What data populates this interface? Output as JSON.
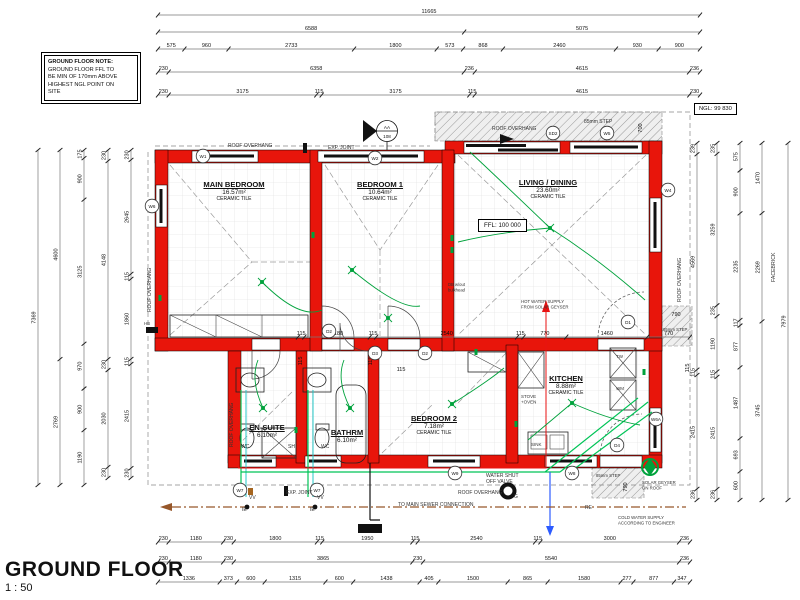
{
  "sheet": {
    "title": "GROUND FLOOR",
    "scale": "1 : 50",
    "note_lines": [
      "GROUND FLOOR NOTE:",
      "GROUND FLOOR FFL TO",
      "BE MIN OF 170mm ABOVE",
      "HIGHEST NGL POINT ON",
      "SITE"
    ],
    "ngl": "NGL: 99 830",
    "ffl": "FFL: 100 000",
    "facebrick": "FACEBRICK",
    "section": {
      "top": "AA",
      "bottom": "108"
    }
  },
  "rooms": [
    {
      "name": "MAIN BEDROOM",
      "area": "16.57m²",
      "finish": "CERAMIC TILE",
      "x": 234,
      "y": 180
    },
    {
      "name": "BEDROOM 1",
      "area": "10.64m²",
      "finish": "CERAMIC TILE",
      "x": 380,
      "y": 180
    },
    {
      "name": "LIVING / DINING",
      "area": "23.60m²",
      "finish": "CERAMIC TILE",
      "x": 548,
      "y": 178
    },
    {
      "name": "EN-SUITE",
      "area": "6.10m²",
      "finish": "",
      "x": 267,
      "y": 423
    },
    {
      "name": "BATHRM",
      "area": "6.10m²",
      "finish": "",
      "x": 347,
      "y": 428
    },
    {
      "name": "BEDROOM 2",
      "area": "7.18m²",
      "finish": "CERAMIC TILE",
      "x": 434,
      "y": 414
    },
    {
      "name": "KITCHEN",
      "area": "8.88m²",
      "finish": "CERAMIC TILE",
      "x": 566,
      "y": 374
    }
  ],
  "markers": [
    {
      "label": "W6",
      "x": 152,
      "y": 206
    },
    {
      "label": "W1",
      "x": 203,
      "y": 156
    },
    {
      "label": "W2",
      "x": 375,
      "y": 158
    },
    {
      "label": "SD2",
      "x": 553,
      "y": 133
    },
    {
      "label": "W5",
      "x": 607,
      "y": 133
    },
    {
      "label": "W4",
      "x": 668,
      "y": 190
    },
    {
      "label": "D1",
      "x": 628,
      "y": 322
    },
    {
      "label": "D2",
      "x": 329,
      "y": 331
    },
    {
      "label": "D3",
      "x": 375,
      "y": 353
    },
    {
      "label": "D2",
      "x": 425,
      "y": 353
    },
    {
      "label": "D4",
      "x": 617,
      "y": 445
    },
    {
      "label": "W7",
      "x": 240,
      "y": 490
    },
    {
      "label": "W7",
      "x": 317,
      "y": 490
    },
    {
      "label": "W9",
      "x": 455,
      "y": 473
    },
    {
      "label": "W8",
      "x": 572,
      "y": 473
    },
    {
      "label": "W6A",
      "x": 656,
      "y": 419
    }
  ],
  "annotations": [
    {
      "t": [
        "ROOF OVERHANG"
      ],
      "x": 228,
      "y": 147
    },
    {
      "t": [
        "EXP. JOINT"
      ],
      "x": 328,
      "y": 149
    },
    {
      "t": [
        "ROOF OVERHANG"
      ],
      "x": 492,
      "y": 130
    },
    {
      "t": [
        "85mm STEP"
      ],
      "x": 584,
      "y": 123
    },
    {
      "t": [
        "ROOF OVERHANG"
      ],
      "x": 151,
      "y": 312,
      "r": -90
    },
    {
      "t": [
        "ROOF OVERHANG"
      ],
      "x": 681,
      "y": 302,
      "r": -90
    },
    {
      "t": [
        "ROOF OVERHANG"
      ],
      "x": 233,
      "y": 447,
      "r": -90
    },
    {
      "t": [
        "ROOF OVERHANG"
      ],
      "x": 458,
      "y": 494
    },
    {
      "t": [
        "EXP. JOINT"
      ],
      "x": 286,
      "y": 494
    },
    {
      "t": [
        "TO MAIN SEWER CONNECTION"
      ],
      "x": 398,
      "y": 506
    },
    {
      "t": [
        "COLD WATER SUPPLY",
        "ACCORDING TO ENGINEER"
      ],
      "x": 618,
      "y": 519,
      "fs": 4.3
    },
    {
      "t": [
        "WATER SHUT",
        "OFF VALVE"
      ],
      "x": 486,
      "y": 477
    },
    {
      "t": [
        "HOT WATER SUPPLY",
        "FROM SOLAR GEYSER"
      ],
      "x": 521,
      "y": 303,
      "c": "#0a7a30",
      "fs": 4.3
    },
    {
      "t": [
        "SOLAR GEYSER",
        "ON ROOF"
      ],
      "x": 642,
      "y": 484,
      "c": "#0a7a30",
      "fs": 4.3
    },
    {
      "t": [
        "85mm STEP"
      ],
      "x": 663,
      "y": 331,
      "fs": 4.3
    },
    {
      "t": [
        "85mm STEP"
      ],
      "x": 596,
      "y": 477,
      "fs": 4.3
    },
    {
      "t": [
        "DB w/out",
        "bulkhead"
      ],
      "x": 448,
      "y": 286,
      "fs": 4.2
    },
    {
      "t": [
        "WC"
      ],
      "x": 241,
      "y": 448
    },
    {
      "t": [
        "SH"
      ],
      "x": 288,
      "y": 448
    },
    {
      "t": [
        "WC"
      ],
      "x": 321,
      "y": 448
    },
    {
      "t": [
        "STOVE",
        "+OVEN"
      ],
      "x": 521,
      "y": 398,
      "fs": 4.5
    },
    {
      "t": [
        "SINK"
      ],
      "x": 531,
      "y": 446,
      "fs": 4.5
    },
    {
      "t": [
        "TW"
      ],
      "x": 616,
      "y": 358,
      "fs": 4.5
    },
    {
      "t": [
        "WM"
      ],
      "x": 616,
      "y": 390,
      "fs": 4.5
    },
    {
      "t": [
        "HB"
      ],
      "x": 144,
      "y": 325,
      "fs": 4.3
    },
    {
      "t": [
        "VV"
      ],
      "x": 249,
      "y": 499
    },
    {
      "t": [
        "VV"
      ],
      "x": 317,
      "y": 499
    },
    {
      "t": [
        "IE"
      ],
      "x": 242,
      "y": 511
    },
    {
      "t": [
        "IE"
      ],
      "x": 310,
      "y": 511
    },
    {
      "t": [
        "G"
      ],
      "x": 514,
      "y": 498
    },
    {
      "t": [
        "RE"
      ],
      "x": 585,
      "y": 509
    },
    {
      "t": [
        "FACEBRICK"
      ],
      "x": 775,
      "y": 282,
      "r": -90,
      "fs": 5.2
    }
  ],
  "solo_dims": [
    {
      "t": "700",
      "x": 642,
      "y": 128,
      "r": -90
    },
    {
      "t": "790",
      "x": 676,
      "y": 316
    },
    {
      "t": "115",
      "x": 689,
      "y": 368,
      "r": -90
    },
    {
      "t": "790",
      "x": 627,
      "y": 487,
      "r": -90
    },
    {
      "t": "115",
      "x": 302,
      "y": 361,
      "r": -90
    },
    {
      "t": "115",
      "x": 372,
      "y": 361,
      "r": -90
    },
    {
      "t": "115",
      "x": 401,
      "y": 371
    }
  ],
  "dims": {
    "chains": [
      {
        "dir": "h",
        "y": 15,
        "x1": 158,
        "x2": 700,
        "v": [
          11665
        ]
      },
      {
        "dir": "h",
        "y": 32,
        "x1": 158,
        "x2": 700,
        "v": [
          6588,
          5075
        ]
      },
      {
        "dir": "h",
        "y": 49,
        "x1": 158,
        "x2": 700,
        "v": [
          575,
          960,
          2733,
          1800,
          573,
          868,
          2460,
          930,
          900
        ]
      },
      {
        "dir": "h",
        "y": 72,
        "x1": 158,
        "x2": 700,
        "v": [
          230,
          6358,
          236,
          4615,
          236
        ]
      },
      {
        "dir": "h",
        "y": 95,
        "x1": 158,
        "x2": 700,
        "v": [
          230,
          3175,
          115,
          3175,
          115,
          4615,
          230
        ]
      },
      {
        "dir": "h",
        "y": 337,
        "x1": 298,
        "x2": 690,
        "v": [
          115,
          1180,
          115,
          2540,
          115,
          770,
          1460,
          770
        ]
      },
      {
        "dir": "h",
        "y": 542,
        "x1": 158,
        "x2": 690,
        "v": [
          230,
          1180,
          230,
          1800,
          115,
          1950,
          115,
          2540,
          115,
          3000,
          236
        ]
      },
      {
        "dir": "h",
        "y": 562,
        "x1": 158,
        "x2": 690,
        "v": [
          230,
          1180,
          230,
          3865,
          230,
          5540,
          236
        ]
      },
      {
        "dir": "h",
        "y": 582,
        "x1": 158,
        "x2": 690,
        "v": [
          1336,
          373,
          600,
          1315,
          600,
          1438,
          405,
          1500,
          865,
          1580,
          277,
          877,
          347
        ]
      },
      {
        "dir": "v",
        "x": 38,
        "y1": 150,
        "y2": 485,
        "v": [
          7369
        ]
      },
      {
        "dir": "v",
        "x": 60,
        "y1": 150,
        "y2": 485,
        "v": [
          4600,
          2769
        ]
      },
      {
        "dir": "v",
        "x": 84,
        "y1": 150,
        "y2": 485,
        "v": [
          175,
          900,
          3125,
          970,
          900,
          1190
        ]
      },
      {
        "dir": "v",
        "x": 108,
        "y1": 150,
        "y2": 478,
        "v": [
          230,
          4148,
          230,
          2030,
          230
        ]
      },
      {
        "dir": "v",
        "x": 131,
        "y1": 150,
        "y2": 478,
        "v": [
          230,
          2645,
          115,
          1860,
          115,
          2415,
          230
        ]
      },
      {
        "dir": "v",
        "x": 697,
        "y1": 143,
        "y2": 500,
        "v": [
          239,
          4569,
          115,
          2415,
          236
        ]
      },
      {
        "dir": "v",
        "x": 717,
        "y1": 143,
        "y2": 500,
        "v": [
          235,
          3259,
          235,
          1190,
          115,
          2415,
          236
        ]
      },
      {
        "dir": "v",
        "x": 740,
        "y1": 143,
        "y2": 500,
        "v": [
          575,
          900,
          2235,
          117,
          877,
          1487,
          693,
          600
        ]
      },
      {
        "dir": "v",
        "x": 762,
        "y1": 143,
        "y2": 500,
        "v": [
          1470,
          2269,
          3745
        ]
      },
      {
        "dir": "v",
        "x": 788,
        "y1": 143,
        "y2": 500,
        "v": [
          7979
        ]
      }
    ]
  },
  "lights": [
    [
      262,
      282
    ],
    [
      352,
      270
    ],
    [
      550,
      228
    ],
    [
      263,
      408
    ],
    [
      350,
      408
    ],
    [
      452,
      404
    ],
    [
      572,
      403
    ],
    [
      388,
      318
    ]
  ],
  "sockets": [
    [
      313,
      235
    ],
    [
      452,
      238
    ],
    [
      452,
      250
    ],
    [
      160,
      298
    ],
    [
      516,
      424
    ],
    [
      644,
      372
    ],
    [
      296,
      430
    ],
    [
      476,
      352
    ]
  ],
  "colors": {
    "wall": "#e8150b",
    "electrical": "#00a23c",
    "pipe_green": "#00c457",
    "pipe_teal": "#24c9c9",
    "hot": "#e81212",
    "cold": "#2d5bff",
    "sewer": "#96572a"
  }
}
